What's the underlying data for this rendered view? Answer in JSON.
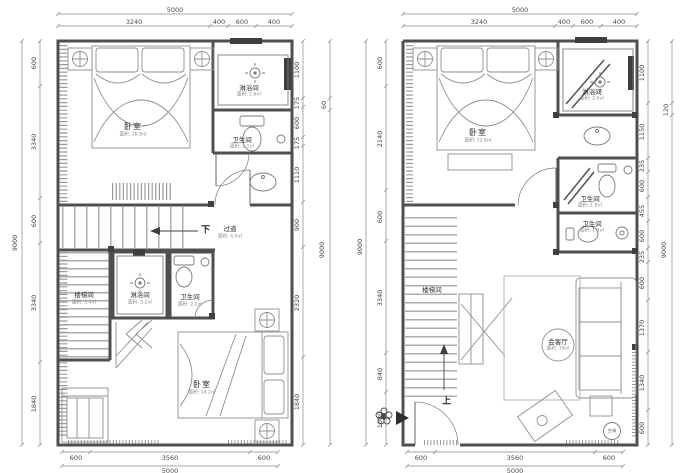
{
  "palette": {
    "wall": "#4f4f4f",
    "thin": "#7a7a7a",
    "dim": "#8a8a8a",
    "furniture": "#8f8f8f",
    "dark": "#3f3f3f",
    "hatch": "#9a9a9a"
  },
  "plans": [
    {
      "id": "left-floor",
      "dims": {
        "top_total": "5000",
        "top_segs": [
          "3240",
          "400",
          "600",
          "400"
        ],
        "left_outer": "9000",
        "left_segs": [
          "600",
          "3340",
          "600",
          "3340",
          "1840"
        ],
        "right_outer": "9000",
        "right_outer_small": "60",
        "right_segs": [
          "1100",
          "175",
          "600",
          "175",
          "1110",
          "900",
          "2320",
          "1840"
        ],
        "bottom_segs": [
          "600",
          "3560",
          "600"
        ],
        "bottom_total": "5000"
      },
      "rooms": {
        "bedroom_top": {
          "label": "卧室",
          "area": "面积: 16.8㎡"
        },
        "shower_top": {
          "label": "淋浴间",
          "area": "面积: 2.6㎡"
        },
        "wc_top": {
          "label": "卫生间",
          "area": "面积: 2.1㎡"
        },
        "corridor": {
          "label": "过道",
          "area": "面积: 4.0㎡"
        },
        "stair": {
          "label": "楼梯间",
          "area": "面积: 3.4㎡"
        },
        "shower_low": {
          "label": "淋浴间",
          "area": "面积: 3.2㎡"
        },
        "wc_low": {
          "label": "卫生间",
          "area": "面积: 2.1㎡"
        },
        "bedroom_low": {
          "label": "卧室",
          "area": "面积: 14.2㎡"
        }
      },
      "annotations": {
        "down": "下"
      }
    },
    {
      "id": "right-floor",
      "dims": {
        "top_total": "5000",
        "top_segs": [
          "3240",
          "400",
          "600",
          "400"
        ],
        "left_outer": "9000",
        "left_segs": [
          "600",
          "2140",
          "600",
          "3340",
          "840",
          "1080"
        ],
        "right_outer": "9000",
        "right_outer_small": "120",
        "right_segs": [
          "1100",
          "1150",
          "235",
          "600",
          "455",
          "600",
          "235",
          "600",
          "1370",
          "1340",
          "600"
        ],
        "bottom_segs": [
          "600",
          "3560",
          "600"
        ],
        "bottom_total": "5000"
      },
      "rooms": {
        "bedroom": {
          "label": "卧室",
          "area": "面积: 12.6㎡"
        },
        "shower": {
          "label": "淋浴间",
          "area": "面积: 2.6㎡"
        },
        "wc1": {
          "label": "卫生间",
          "area": "面积: 1.8㎡"
        },
        "wc2": {
          "label": "卫生间",
          "area": "面积: 1.4㎡"
        },
        "stair": {
          "label": "楼梯间"
        },
        "living": {
          "label": "会客厅",
          "area": "面积: 19㎡"
        },
        "ac": {
          "label": "空调"
        }
      },
      "annotations": {
        "up": "上"
      }
    }
  ]
}
